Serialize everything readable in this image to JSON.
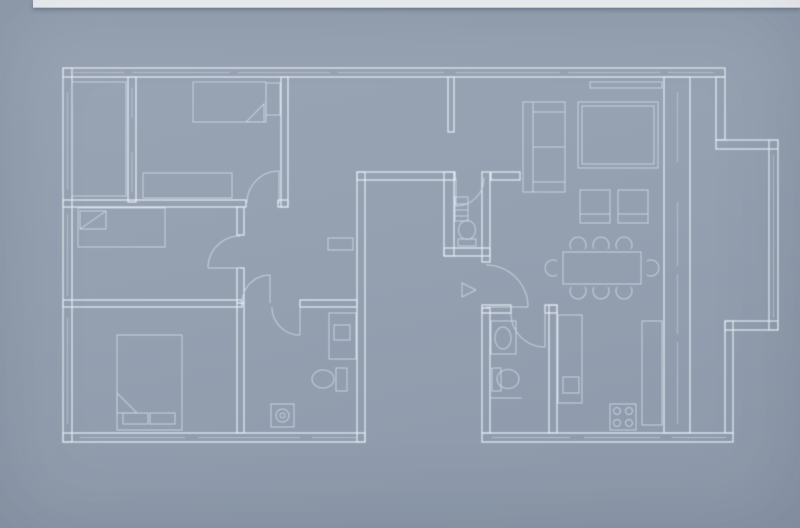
{
  "scene": {
    "kind": "architectural-floor-plan-blueprint"
  },
  "colors": {
    "bg_top": "#99a4b4",
    "bg_mid": "#95a1b1",
    "bg_bottom": "#8d99aa",
    "wall_line": "#e6edf6",
    "detail_line": "#ccd7e4",
    "window_line": "#bccada",
    "top_bar": "#f6f8fa",
    "top_bar_shadow": "rgba(50,62,80,0.35)"
  },
  "floor_plan": {
    "walls": [
      {
        "n": "outer-wall-top",
        "x": 63,
        "y": 68,
        "w": 662,
        "h": 9
      },
      {
        "n": "outer-wall-left",
        "x": 63,
        "y": 68,
        "w": 9,
        "h": 374
      },
      {
        "n": "outer-wall-bottom-left-wing",
        "x": 63,
        "y": 433,
        "w": 302,
        "h": 9
      },
      {
        "n": "patio-wall-left",
        "x": 357,
        "y": 172,
        "w": 8,
        "h": 270
      },
      {
        "n": "patio-wall-top",
        "x": 357,
        "y": 172,
        "w": 98,
        "h": 8
      },
      {
        "n": "patio-wall-right",
        "x": 444,
        "y": 172,
        "w": 10,
        "h": 84
      },
      {
        "n": "hall-jog-wall",
        "x": 444,
        "y": 248,
        "w": 46,
        "h": 8
      },
      {
        "n": "wc-east-wall",
        "x": 482,
        "y": 172,
        "w": 8,
        "h": 90
      },
      {
        "n": "west-wall-below-entrance",
        "x": 482,
        "y": 308,
        "w": 8,
        "h": 125
      },
      {
        "n": "outer-wall-bottom-right-wing",
        "x": 482,
        "y": 433,
        "w": 251,
        "h": 9
      },
      {
        "n": "east-wall",
        "x": 664,
        "y": 77,
        "w": 26,
        "h": 356
      },
      {
        "n": "bay-wall-upper-right",
        "x": 716,
        "y": 77,
        "w": 9,
        "h": 63
      },
      {
        "n": "bay-step-upper",
        "x": 716,
        "y": 140,
        "w": 62,
        "h": 9
      },
      {
        "n": "outer-wall-far-right",
        "x": 769,
        "y": 140,
        "w": 9,
        "h": 190
      },
      {
        "n": "bay-step-lower",
        "x": 725,
        "y": 321,
        "w": 53,
        "h": 9
      },
      {
        "n": "outer-wall-right-lower",
        "x": 725,
        "y": 321,
        "w": 8,
        "h": 112
      },
      {
        "n": "balcony-partition",
        "x": 128,
        "y": 77,
        "w": 8,
        "h": 125
      },
      {
        "n": "bedroom-a-south-wall",
        "x": 63,
        "y": 200,
        "w": 183,
        "h": 7
      },
      {
        "n": "bedroom-a-south-stub",
        "x": 278,
        "y": 200,
        "w": 10,
        "h": 7
      },
      {
        "n": "bedroom-a-east-wall",
        "x": 281,
        "y": 77,
        "w": 7,
        "h": 130
      },
      {
        "n": "partial-wall-hall-top",
        "x": 448,
        "y": 77,
        "w": 6,
        "h": 55
      },
      {
        "n": "corridor-wall-upper",
        "x": 237,
        "y": 207,
        "w": 7,
        "h": 28
      },
      {
        "n": "corridor-wall-lower",
        "x": 237,
        "y": 268,
        "w": 7,
        "h": 35
      },
      {
        "n": "bedroom-divider-west",
        "x": 63,
        "y": 300,
        "w": 179,
        "h": 7
      },
      {
        "n": "bedroom-divider-east",
        "x": 300,
        "y": 300,
        "w": 57,
        "h": 7
      },
      {
        "n": "bedroom-c-east-wall",
        "x": 237,
        "y": 303,
        "w": 7,
        "h": 130
      },
      {
        "n": "hall-living-wall",
        "x": 491,
        "y": 172,
        "w": 29,
        "h": 8
      },
      {
        "n": "bathroom2-north-wall-west",
        "x": 482,
        "y": 305,
        "w": 29,
        "h": 8
      },
      {
        "n": "bathroom2-north-wall-east",
        "x": 545,
        "y": 305,
        "w": 12,
        "h": 8
      },
      {
        "n": "kitchen-bathroom-divider",
        "x": 549,
        "y": 305,
        "w": 8,
        "h": 128
      }
    ],
    "windows": [
      {
        "n": "window-top-1",
        "x1": 70,
        "y1": 72.5,
        "x2": 124,
        "y2": 72.5
      },
      {
        "n": "window-top-2",
        "x1": 132,
        "y1": 72.5,
        "x2": 230,
        "y2": 72.5
      },
      {
        "n": "window-top-3",
        "x1": 238,
        "y1": 72.5,
        "x2": 330,
        "y2": 72.5
      },
      {
        "n": "window-top-4",
        "x1": 338,
        "y1": 72.5,
        "x2": 444,
        "y2": 72.5
      },
      {
        "n": "window-top-5",
        "x1": 456,
        "y1": 72.5,
        "x2": 560,
        "y2": 72.5
      },
      {
        "n": "window-top-6",
        "x1": 568,
        "y1": 72.5,
        "x2": 660,
        "y2": 72.5
      },
      {
        "n": "window-top-7",
        "x1": 668,
        "y1": 72.5,
        "x2": 714,
        "y2": 72.5
      },
      {
        "n": "window-east-1",
        "x1": 677.5,
        "y1": 92,
        "x2": 677.5,
        "y2": 162
      },
      {
        "n": "window-east-2",
        "x1": 677.5,
        "y1": 202,
        "x2": 677.5,
        "y2": 266
      },
      {
        "n": "window-east-3",
        "x1": 677.5,
        "y1": 274,
        "x2": 677.5,
        "y2": 334
      },
      {
        "n": "window-east-4",
        "x1": 677.5,
        "y1": 342,
        "x2": 677.5,
        "y2": 424
      },
      {
        "n": "window-west-1",
        "x1": 67.5,
        "y1": 92,
        "x2": 67.5,
        "y2": 190
      },
      {
        "n": "window-west-2",
        "x1": 67.5,
        "y1": 214,
        "x2": 67.5,
        "y2": 296
      },
      {
        "n": "window-west-3",
        "x1": 67.5,
        "y1": 318,
        "x2": 67.5,
        "y2": 424
      },
      {
        "n": "window-bottom-left-1",
        "x1": 80,
        "y1": 437.5,
        "x2": 185,
        "y2": 437.5
      },
      {
        "n": "window-bottom-left-2",
        "x1": 198,
        "y1": 437.5,
        "x2": 300,
        "y2": 437.5
      },
      {
        "n": "window-bottom-left-3",
        "x1": 312,
        "y1": 437.5,
        "x2": 356,
        "y2": 437.5
      },
      {
        "n": "window-bottom-right-1",
        "x1": 492,
        "y1": 437.5,
        "x2": 570,
        "y2": 437.5
      },
      {
        "n": "window-bottom-right-2",
        "x1": 584,
        "y1": 437.5,
        "x2": 660,
        "y2": 437.5
      },
      {
        "n": "window-bottom-right-3",
        "x1": 672,
        "y1": 437.5,
        "x2": 726,
        "y2": 437.5
      },
      {
        "n": "window-far-right",
        "x1": 773.5,
        "y1": 155,
        "x2": 773.5,
        "y2": 318
      },
      {
        "n": "window-balcony-1",
        "x1": 132,
        "y1": 88,
        "x2": 132,
        "y2": 118
      },
      {
        "n": "window-balcony-2",
        "x1": 132,
        "y1": 152,
        "x2": 132,
        "y2": 192
      }
    ],
    "doors": [
      {
        "n": "door-bedroom-a",
        "leaf": [
          279,
          203,
          279,
          171
        ],
        "arc": "M 247 203 A 32 32 0 0 1 279 171"
      },
      {
        "n": "door-bedroom-b",
        "leaf": [
          240,
          268,
          208,
          268
        ],
        "arc": "M 240 236 A 32 32 0 0 0 208 268"
      },
      {
        "n": "door-corridor",
        "leaf": [
          270,
          303,
          270,
          275
        ],
        "arc": "M 242 303 A 28 28 0 0 1 270 275"
      },
      {
        "n": "door-bathroom-1",
        "leaf": [
          300,
          307,
          300,
          335
        ],
        "arc": "M 272 307 A 28 28 0 0 0 300 335"
      },
      {
        "n": "door-wc",
        "leaf": [
          456,
          178,
          456,
          206
        ],
        "arc": "M 484 178 A 28 28 0 0 1 456 206"
      },
      {
        "n": "door-entrance",
        "leaf": [
          486,
          307,
          528,
          307
        ],
        "arc": "M 486 265 A 42 42 0 0 1 528 307"
      },
      {
        "n": "door-bathroom-2",
        "leaf": [
          545,
          313,
          545,
          347
        ],
        "arc": "M 511 313 A 34 34 0 0 0 545 347"
      }
    ],
    "furniture": {
      "rects": [
        {
          "n": "bed-1",
          "x": 193,
          "y": 82,
          "w": 73,
          "h": 40
        },
        {
          "n": "bed-1-nightstand",
          "x": 266,
          "y": 83,
          "w": 14,
          "h": 32
        },
        {
          "n": "dresser-1",
          "x": 143,
          "y": 173,
          "w": 89,
          "h": 25
        },
        {
          "n": "balcony-floor-line",
          "x": 72,
          "y": 82,
          "w": 54,
          "h": 114
        },
        {
          "n": "bed-2",
          "x": 78,
          "y": 208,
          "w": 87,
          "h": 39
        },
        {
          "n": "bed-2-pillow",
          "x": 80,
          "y": 211,
          "w": 26,
          "h": 18
        },
        {
          "n": "bed-3",
          "x": 117,
          "y": 335,
          "w": 65,
          "h": 95
        },
        {
          "n": "bed-3-pillow-left",
          "x": 123,
          "y": 413,
          "w": 25,
          "h": 11
        },
        {
          "n": "bed-3-pillow-right",
          "x": 150,
          "y": 413,
          "w": 25,
          "h": 11
        },
        {
          "n": "hall-shelf",
          "x": 328,
          "y": 238,
          "w": 25,
          "h": 12
        },
        {
          "n": "washing-machine",
          "x": 271,
          "y": 404,
          "w": 23,
          "h": 23
        },
        {
          "n": "toilet-1-tank",
          "x": 336,
          "y": 368,
          "w": 11,
          "h": 23
        },
        {
          "n": "vanity-1",
          "x": 329,
          "y": 313,
          "w": 27,
          "h": 46
        },
        {
          "n": "vanity-1-basin",
          "x": 334,
          "y": 325,
          "w": 16,
          "h": 15
        },
        {
          "n": "wc-radiator",
          "x": 455,
          "y": 197,
          "w": 13,
          "h": 24
        },
        {
          "n": "wc-toilet-tank",
          "x": 458,
          "y": 239,
          "w": 18,
          "h": 7
        },
        {
          "n": "sink-2",
          "x": 491,
          "y": 321,
          "w": 25,
          "h": 33
        },
        {
          "n": "toilet-2-tank",
          "x": 492,
          "y": 368,
          "w": 9,
          "h": 23
        },
        {
          "n": "kitchen-counter-west",
          "x": 558,
          "y": 315,
          "w": 24,
          "h": 88
        },
        {
          "n": "kitchen-sink",
          "x": 563,
          "y": 377,
          "w": 16,
          "h": 16
        },
        {
          "n": "kitchen-counter-east",
          "x": 642,
          "y": 321,
          "w": 20,
          "h": 104
        },
        {
          "n": "stove",
          "x": 610,
          "y": 404,
          "w": 26,
          "h": 26
        },
        {
          "n": "sofa",
          "x": 523,
          "y": 102,
          "w": 42,
          "h": 90
        },
        {
          "n": "rug",
          "x": 578,
          "y": 102,
          "w": 80,
          "h": 66
        },
        {
          "n": "rug-inner",
          "x": 582,
          "y": 106,
          "w": 72,
          "h": 58
        },
        {
          "n": "window-sill-living",
          "x": 590,
          "y": 82,
          "w": 72,
          "h": 6
        },
        {
          "n": "armchair-1",
          "x": 580,
          "y": 190,
          "w": 30,
          "h": 33
        },
        {
          "n": "armchair-2",
          "x": 618,
          "y": 190,
          "w": 30,
          "h": 33
        },
        {
          "n": "dining-table",
          "x": 563,
          "y": 252,
          "w": 78,
          "h": 32
        }
      ],
      "lines": [
        {
          "n": "bed-2-pillow-fold",
          "x1": 80,
          "y1": 229,
          "x2": 106,
          "y2": 211
        },
        {
          "n": "sofa-back-line",
          "x1": 533,
          "y1": 102,
          "x2": 533,
          "y2": 192
        },
        {
          "n": "sofa-armrest-top",
          "x1": 533,
          "y1": 112,
          "x2": 565,
          "y2": 112
        },
        {
          "n": "sofa-cushion-divide",
          "x1": 533,
          "y1": 147,
          "x2": 565,
          "y2": 147
        },
        {
          "n": "sofa-armrest-bottom",
          "x1": 533,
          "y1": 182,
          "x2": 565,
          "y2": 182
        },
        {
          "n": "armchair-1-seat-line",
          "x1": 580,
          "y1": 214,
          "x2": 610,
          "y2": 214
        },
        {
          "n": "armchair-2-seat-line",
          "x1": 618,
          "y1": 214,
          "x2": 648,
          "y2": 214
        },
        {
          "n": "wc-radiator-line-1",
          "x1": 455,
          "y1": 204,
          "x2": 468,
          "y2": 204
        },
        {
          "n": "wc-radiator-line-2",
          "x1": 455,
          "y1": 210,
          "x2": 468,
          "y2": 210
        },
        {
          "n": "wc-radiator-line-3",
          "x1": 455,
          "y1": 216,
          "x2": 468,
          "y2": 216
        },
        {
          "n": "bathroom2-shelf-line",
          "x1": 491,
          "y1": 398,
          "x2": 522,
          "y2": 398
        }
      ],
      "circles": [
        {
          "n": "washing-machine-drum",
          "cx": 282.5,
          "cy": 415.5,
          "r": 6.5
        },
        {
          "n": "washing-machine-drum-inner",
          "cx": 282.5,
          "cy": 415.5,
          "r": 2.5
        },
        {
          "n": "stove-burner-1",
          "cx": 617,
          "cy": 411,
          "r": 3.5
        },
        {
          "n": "stove-burner-2",
          "cx": 629,
          "cy": 411,
          "r": 3.5
        },
        {
          "n": "stove-burner-3",
          "cx": 617,
          "cy": 423,
          "r": 3.5
        },
        {
          "n": "stove-burner-4",
          "cx": 629,
          "cy": 423,
          "r": 3.5
        }
      ],
      "ellipses": [
        {
          "n": "toilet-1-bowl",
          "cx": 323,
          "cy": 379,
          "rx": 11,
          "ry": 9
        },
        {
          "n": "wc-toilet-bowl",
          "cx": 467,
          "cy": 230,
          "rx": 8.5,
          "ry": 9.5
        },
        {
          "n": "sink-2-basin",
          "cx": 503,
          "cy": 338,
          "rx": 8,
          "ry": 11
        },
        {
          "n": "toilet-2-bowl",
          "cx": 508,
          "cy": 379,
          "rx": 11,
          "ry": 9.5
        }
      ],
      "paths": [
        {
          "n": "bed-1-fold",
          "d": "M 246 122 L 264 104 L 264 122 Z"
        },
        {
          "n": "bed-3-fold",
          "d": "M 117 393 L 137 413 L 117 413 Z"
        },
        {
          "n": "entrance-arrow",
          "d": "M 462 283 L 476 290 L 462 297 Z"
        },
        {
          "n": "dining-chair-top-1",
          "d": "M 571 249 A 8 8 0 1 1 585 249"
        },
        {
          "n": "dining-chair-top-2",
          "d": "M 594 249 A 8 8 0 1 1 608 249"
        },
        {
          "n": "dining-chair-top-3",
          "d": "M 617 249 A 8 8 0 1 1 631 249"
        },
        {
          "n": "dining-chair-bottom-1",
          "d": "M 571 287 A 8 8 0 1 0 585 287"
        },
        {
          "n": "dining-chair-bottom-2",
          "d": "M 594 287 A 8 8 0 1 0 608 287"
        },
        {
          "n": "dining-chair-bottom-3",
          "d": "M 617 287 A 8 8 0 1 0 631 287"
        },
        {
          "n": "dining-chair-left",
          "d": "M 557 261 A 8 8 0 1 0 557 275"
        },
        {
          "n": "dining-chair-right",
          "d": "M 647 261 A 8 8 0 1 1 647 275"
        }
      ]
    }
  }
}
